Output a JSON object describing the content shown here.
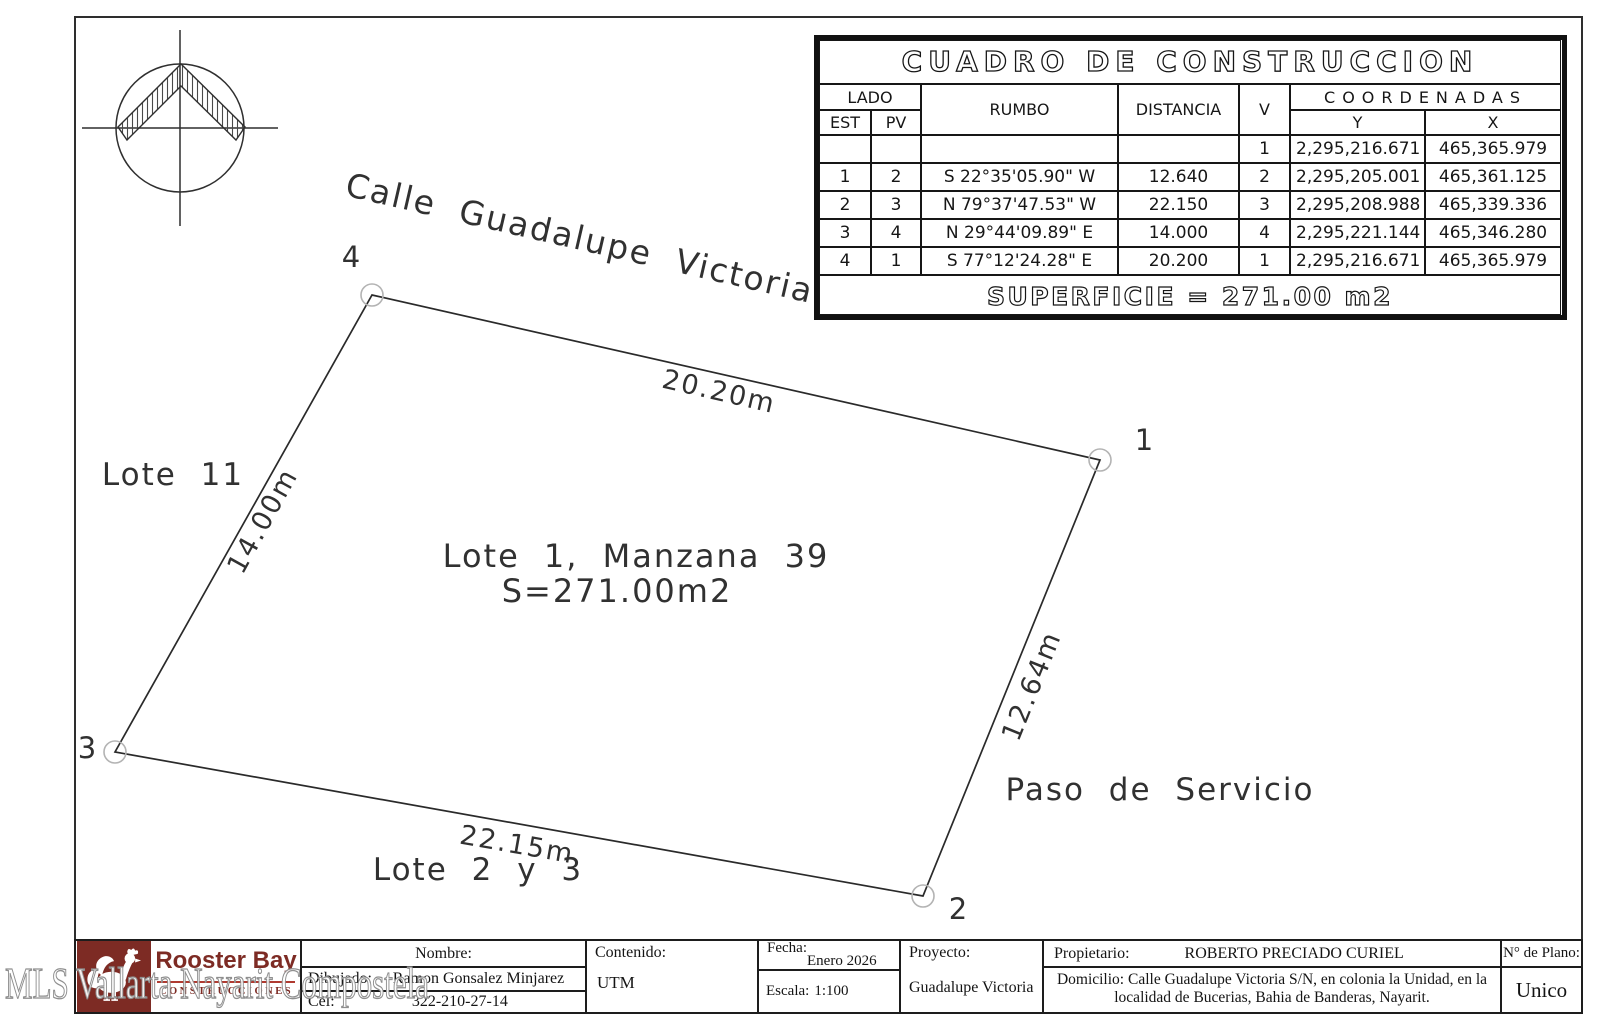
{
  "drawing": {
    "street_label": "Calle Guadalupe Victoria",
    "dim_top": "20.20m",
    "dim_left": "14.00m",
    "dim_right": "12.64m",
    "dim_bottom": "22.15m",
    "lot_title": "Lote 1, Manzana 39",
    "lot_area": "S=271.00m2",
    "neighbor_left": "Lote 11",
    "neighbor_bottom": "Lote 2 y 3",
    "service_path": "Paso de Servicio",
    "vertex_1": "1",
    "vertex_2": "2",
    "vertex_3": "3",
    "vertex_4": "4"
  },
  "construction_table": {
    "title": "CUADRO DE CONSTRUCCION",
    "headers": {
      "lado": "LADO",
      "est": "EST",
      "pv": "PV",
      "rumbo": "RUMBO",
      "distancia": "DISTANCIA",
      "v": "V",
      "coordenadas": "COORDENADAS",
      "y": "Y",
      "x": "X"
    },
    "rows": [
      {
        "est": "",
        "pv": "",
        "rumbo": "",
        "distancia": "",
        "v": "1",
        "y": "2,295,216.671",
        "x": "465,365.979"
      },
      {
        "est": "1",
        "pv": "2",
        "rumbo": "S 22°35'05.90\" W",
        "distancia": "12.640",
        "v": "2",
        "y": "2,295,205.001",
        "x": "465,361.125"
      },
      {
        "est": "2",
        "pv": "3",
        "rumbo": "N 79°37'47.53\" W",
        "distancia": "22.150",
        "v": "3",
        "y": "2,295,208.988",
        "x": "465,339.336"
      },
      {
        "est": "3",
        "pv": "4",
        "rumbo": "N 29°44'09.89\" E",
        "distancia": "14.000",
        "v": "4",
        "y": "2,295,221.144",
        "x": "465,346.280"
      },
      {
        "est": "4",
        "pv": "1",
        "rumbo": "S 77°12'24.28\" E",
        "distancia": "20.200",
        "v": "1",
        "y": "2,295,216.671",
        "x": "465,365.979"
      }
    ],
    "superficie": "SUPERFICIE = 271.00 m2"
  },
  "title_block": {
    "brand_name": "Rooster Bay",
    "brand_subtitle": "CONSTRUCCIONES",
    "nombre_label": "Nombre:",
    "dibujado_label": "Dibujado:",
    "dibujado_value": "Ramon Gonsalez Minjarez",
    "cel_label": "Cel:",
    "cel_value": "322-210-27-14",
    "contenido_label": "Contenido:",
    "contenido_value": "UTM",
    "fecha_label": "Fecha:",
    "fecha_value": "Enero 2026",
    "escala_label": "Escala:",
    "escala_value": "1:100",
    "proyecto_label": "Proyecto:",
    "proyecto_value": "Guadalupe Victoria",
    "propietario_label": "Propietario:",
    "propietario_value": "ROBERTO PRECIADO CURIEL",
    "domicilio_label": "Domicilio:",
    "domicilio_value": "Calle Guadalupe Victoria S/N, en colonia la Unidad, en la localidad de Bucerias, Bahia de Banderas, Nayarit.",
    "plano_label": "N° de Plano:",
    "plano_value": "Unico"
  },
  "watermark": "MLS Vallarta Nayarit Compostela",
  "colors": {
    "brand_maroon": "#7d2b24",
    "brand_red": "#b03a30",
    "line": "#2f2f2f"
  }
}
